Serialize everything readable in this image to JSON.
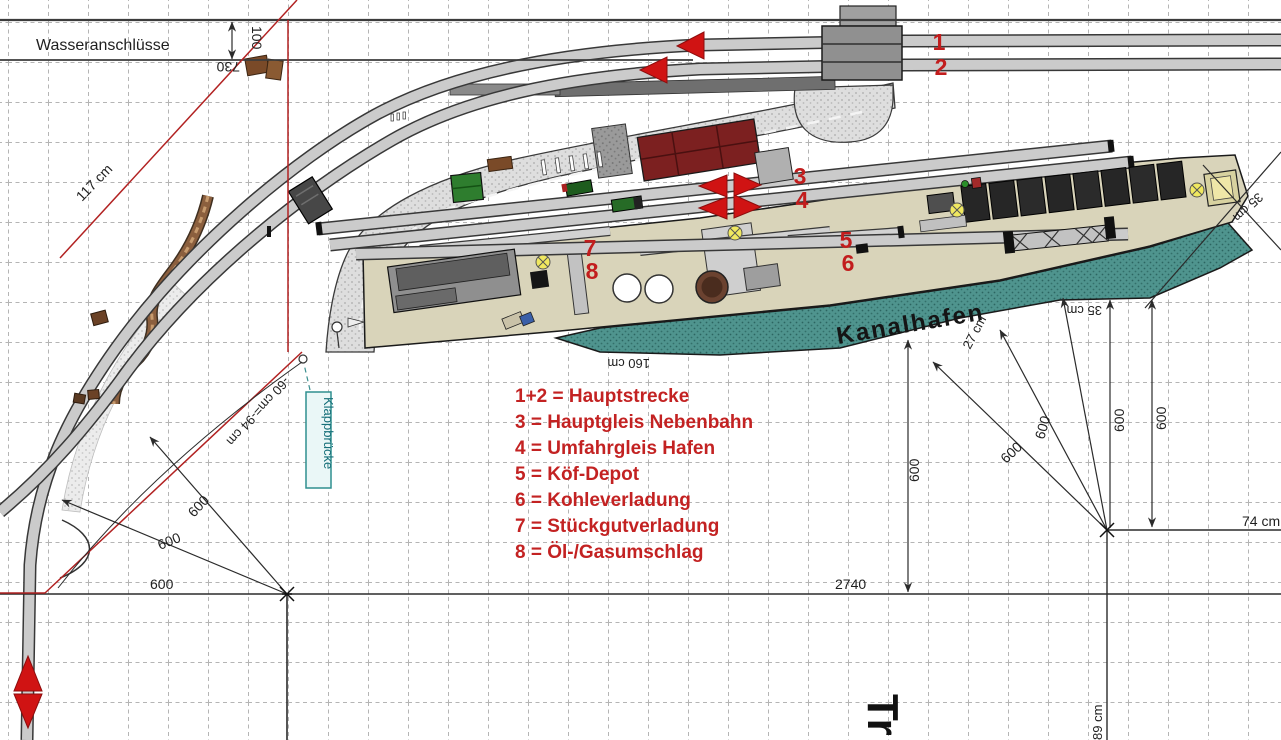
{
  "canvas": {
    "width": 1281,
    "height": 740
  },
  "labels": {
    "wasseranschluesse": "Wasseranschlüsse",
    "kanalhafen": "Kanalhafen",
    "klappbruecke": "Klappbrücke",
    "tr_partial": "Tr"
  },
  "legend": {
    "lines": [
      "1+2 = Hauptstrecke",
      "3 = Hauptgleis Nebenbahn",
      "4 = Umfahrgleis Hafen",
      "5 = Köf-Depot",
      "6 = Kohleverladung",
      "7 = Stückgutverladung",
      "8 = Öl-/Gasumschlag"
    ]
  },
  "track_numbers": {
    "n1": "1",
    "n2": "2",
    "n3": "3",
    "n4": "4",
    "n5": "5",
    "n6": "6",
    "n7": "7",
    "n8": "8"
  },
  "dimensions": {
    "d730": "730",
    "d100": "100",
    "d117": "117 cm",
    "d160": "160 cm",
    "d2740": "2740",
    "d600": "600",
    "d74": "74 cm",
    "d89": "89 cm",
    "d27": "27 cm",
    "d35": "35 cm",
    "d60_94": "-60 cm=-94 cm"
  },
  "colors": {
    "marker_red": "#d01313",
    "legend_red": "#c32222",
    "construction_red": "#b22222",
    "water_teal": "#4f948e",
    "pier_tan": "#d9d4ba",
    "track_gray": "#cbcbcb",
    "klapp_teal": "#17707a"
  }
}
